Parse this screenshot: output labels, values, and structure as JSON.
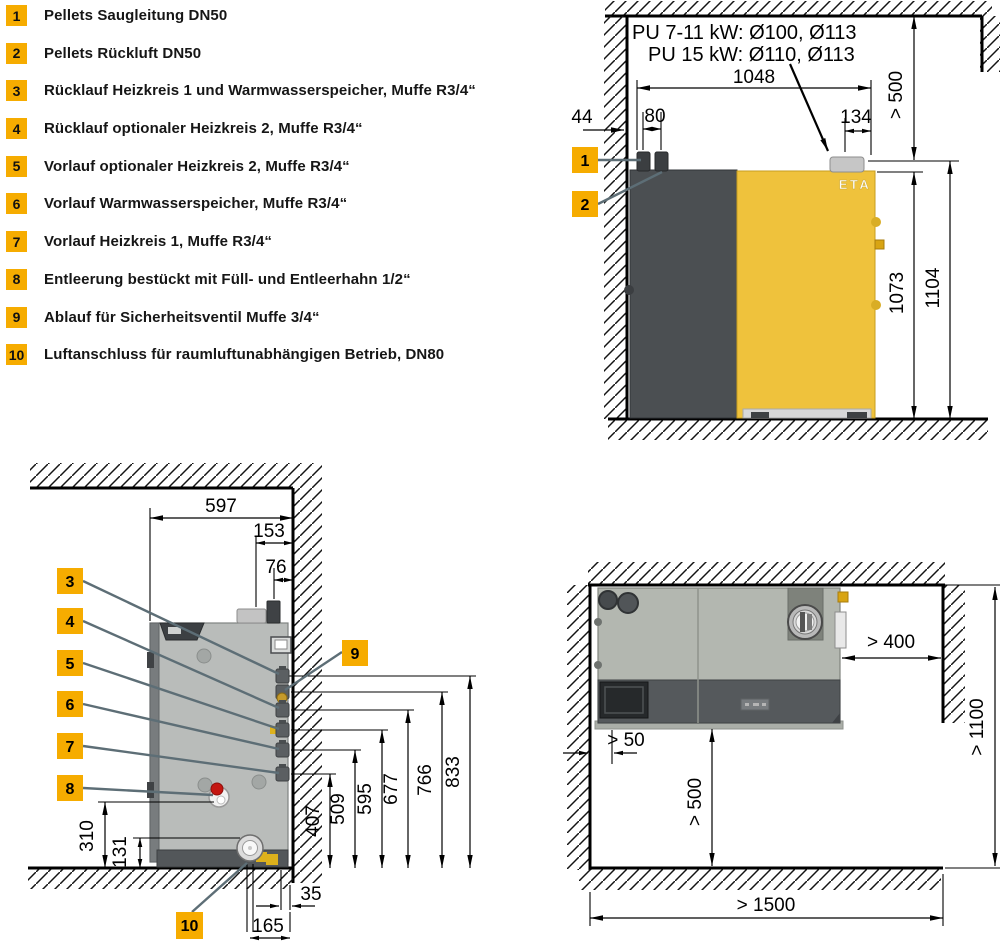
{
  "legend": {
    "items": [
      {
        "num": "1",
        "text": "Pellets Saugleitung DN50"
      },
      {
        "num": "2",
        "text": "Pellets Rückluft DN50"
      },
      {
        "num": "3",
        "text": "Rücklauf Heizkreis 1 und Warmwasserspeicher, Muffe R3/4“"
      },
      {
        "num": "4",
        "text": "Rücklauf optionaler Heizkreis 2, Muffe R3/4“"
      },
      {
        "num": "5",
        "text": "Vorlauf optionaler Heizkreis 2, Muffe R3/4“"
      },
      {
        "num": "6",
        "text": "Vorlauf Warmwasserspeicher, Muffe R3/4“"
      },
      {
        "num": "7",
        "text": "Vorlauf Heizkreis 1, Muffe R3/4“"
      },
      {
        "num": "8",
        "text": "Entleerung bestückt mit Füll- und Entleerhahn 1/2“"
      },
      {
        "num": "9",
        "text": "Ablauf für Sicherheitsventil Muffe 3/4“"
      },
      {
        "num": "10",
        "text": "Luftanschluss für raumluftunabhängigen Betrieb, DN80"
      }
    ]
  },
  "front_view": {
    "note_line1": "PU 7-11 kW: Ø100, Ø113",
    "note_line2": "PU 15 kW: Ø110, Ø113",
    "brand_logo": "ETA",
    "callouts": [
      "1",
      "2"
    ],
    "dims": {
      "width": "1048",
      "wall_gap": "44",
      "pipe_spacing": "80",
      "flue_offset": "134",
      "ceiling_clearance": "> 500",
      "body_height": "1073",
      "total_height": "1104"
    }
  },
  "side_view": {
    "callouts": [
      "3",
      "4",
      "5",
      "6",
      "7",
      "8",
      "9",
      "10"
    ],
    "dims": {
      "depth": "597",
      "flue_to_wall": "153",
      "pipe_to_wall": "76",
      "conn_h1": "407",
      "conn_h2": "509",
      "conn_h3": "595",
      "conn_h4": "677",
      "conn_h5": "766",
      "conn_h6": "833",
      "drain_h": "310",
      "air_h": "131",
      "rear_gap": "35",
      "air_to_wall": "165"
    }
  },
  "top_view": {
    "dims": {
      "side_gap": "> 50",
      "right_clearance": "> 400",
      "front_clearance": "> 500",
      "room_depth": "> 1100",
      "room_width": "> 1500"
    }
  },
  "colors": {
    "accent_yellow": "#F6AC00",
    "boiler_yellow": "#EFC23C",
    "hopper_gray": "#4B4F52",
    "leader_gray": "#5D6E76"
  }
}
